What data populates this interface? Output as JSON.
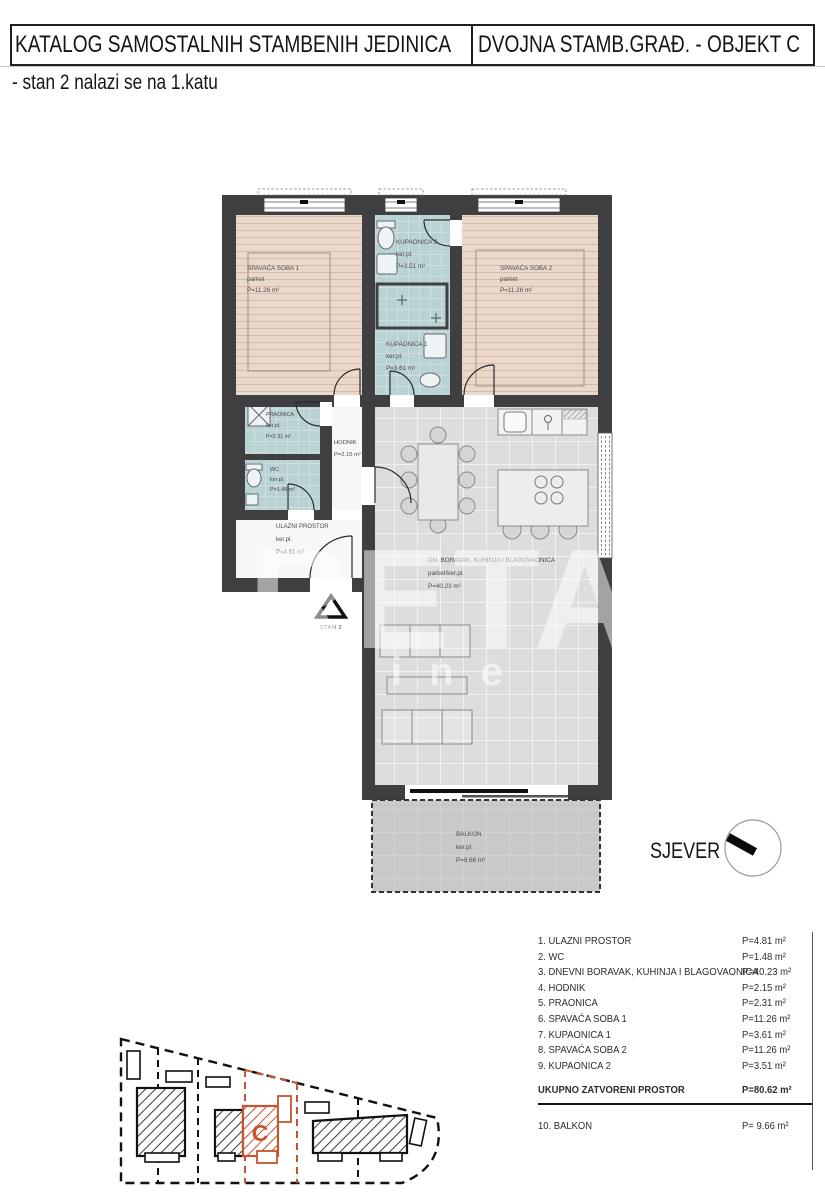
{
  "header": {
    "catalog_title": "KATALOG SAMOSTALNIH STAMBENIH JEDINICA",
    "object_title": "DVOJNA STAMB.GRAĐ. - OBJEKT C",
    "subtitle": "- stan 2 nalazi se na 1.katu"
  },
  "floor_plan": {
    "rooms": {
      "spavaca_soba_1": {
        "name": "SPAVAĆA SOBA 1",
        "floor": "parket",
        "area": "P=11.26 m²"
      },
      "kupaonica_2": {
        "name": "KUPAONICA 2",
        "floor": "ker.pl.",
        "area": "P=3.51 m²"
      },
      "spavaca_soba_2": {
        "name": "SPAVAĆA SOBA 2",
        "floor": "parket",
        "area": "P=11.26 m²"
      },
      "kupaonica_1": {
        "name": "KUPAONICA 1",
        "floor": "ker.pl.",
        "area": "P=3.61 m²"
      },
      "praonica": {
        "name": "PRAONICA",
        "floor": "ker.pl.",
        "area": "P=2.31 m²"
      },
      "hodnik": {
        "name": "HODNIK",
        "area": "P=2.15 m²"
      },
      "wc": {
        "name": "WC",
        "floor": "ker.pl.",
        "area": "P=1.48 m²"
      },
      "ulazni_prostor": {
        "name": "ULAZNI PROSTOR",
        "floor": "ker.pl.",
        "area": "P=4.81 m²"
      },
      "dnevni_boravak": {
        "name": "DN. BORAVAK, KUHINJA I BLAGOVAONICA",
        "floor": "parket/ker.pl.",
        "area": "P=40.23 m²"
      },
      "balkon": {
        "name": "BALKON",
        "floor": "ker.pl.",
        "area": "P=9.66 m²"
      }
    },
    "entry_marker": "STAN 2",
    "north_label": "SJEVER"
  },
  "area_table": {
    "rows": [
      {
        "label": "1. ULAZNI PROSTOR",
        "value": "P=4.81 m²"
      },
      {
        "label": "2. WC",
        "value": "P=1.48 m²"
      },
      {
        "label": "3. DNEVNI BORAVAK, KUHINJA I BLAGOVAONICA",
        "value": "P=40.23 m²"
      },
      {
        "label": "4. HODNIK",
        "value": "P=2.15 m²"
      },
      {
        "label": "5. PRAONICA",
        "value": "P=2.31 m²"
      },
      {
        "label": "6. SPAVAĆA SOBA 1",
        "value": "P=11.26 m²"
      },
      {
        "label": "7. KUPAONICA 1",
        "value": "P=3.61 m²"
      },
      {
        "label": "8. SPAVAĆA SOBA 2",
        "value": "P=11.26 m²"
      },
      {
        "label": "9. KUPAONICA 2",
        "value": "P=3.51 m²"
      }
    ],
    "total": {
      "label": "UKUPNO ZATVORENI PROSTOR",
      "value": "P=80.62 m²"
    },
    "extra_row": {
      "label": "10. BALKON",
      "value": "P= 9.66 m²"
    }
  },
  "site_plan": {
    "unit_label": "C",
    "highlight_color": "#c7552e"
  },
  "watermark": {
    "big": "RETA",
    "small": "etnine"
  },
  "colors": {
    "wall": "#3f3f41",
    "bedroom_floor": "#ead9cb",
    "bath_floor": "#b9d2d3",
    "living_floor": "#dcdddf",
    "balcony_floor": "#c8c9ca",
    "accent_orange": "#c7552e"
  }
}
